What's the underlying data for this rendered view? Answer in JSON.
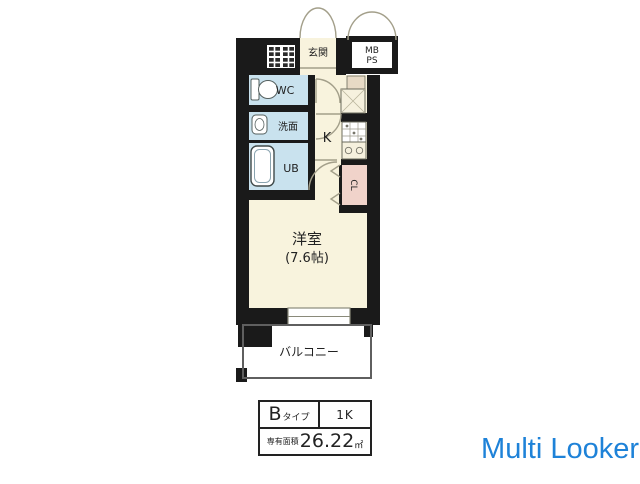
{
  "floorplan": {
    "labels": {
      "genkan": "玄関",
      "mb": "MB",
      "ps": "PS",
      "wc": "WC",
      "senmen": "洗面",
      "ub": "UB",
      "kitchen": "K",
      "closet": "CL",
      "room_name": "洋室",
      "room_size": "(7.6帖)",
      "balcony": "バルコニー"
    },
    "info_table": {
      "type_main": "B",
      "type_suffix": "タイプ",
      "layout": "1K",
      "area_label": "専有面積",
      "area_value": "26.22",
      "area_unit": "㎡"
    },
    "colors": {
      "wall": "#1a1a1a",
      "room_floor": "#f8f3dd",
      "wet_area": "#c9e2ee",
      "closet_fill": "#f0d3ca",
      "fixture_stroke": "#6b6b5c",
      "door_arc": "#a39f8a"
    }
  },
  "watermark": {
    "text": "Multi Looker",
    "color": "#1e82d8"
  }
}
